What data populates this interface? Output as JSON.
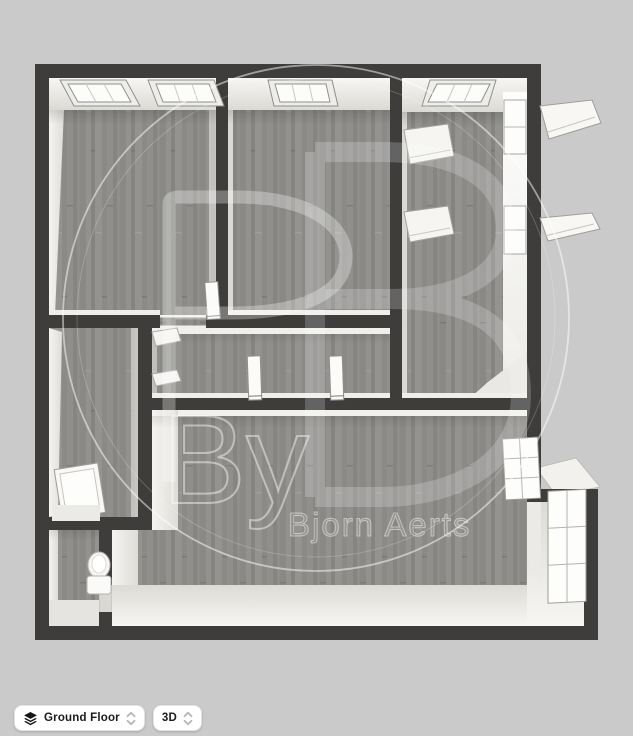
{
  "colors": {
    "background": "#cacaca",
    "wall": "#3e3d3c",
    "floor": "#8e8d8a",
    "wall_face": "#f3f1ed"
  },
  "watermark": {
    "monogram": "BP",
    "by_label": "By",
    "author_name": "Bjorn Aerts"
  },
  "toolbar": {
    "floor_selector": {
      "label": "Ground Floor",
      "icon": "layers-icon"
    },
    "view_selector": {
      "label": "3D",
      "icon": "spinner-icon"
    }
  }
}
